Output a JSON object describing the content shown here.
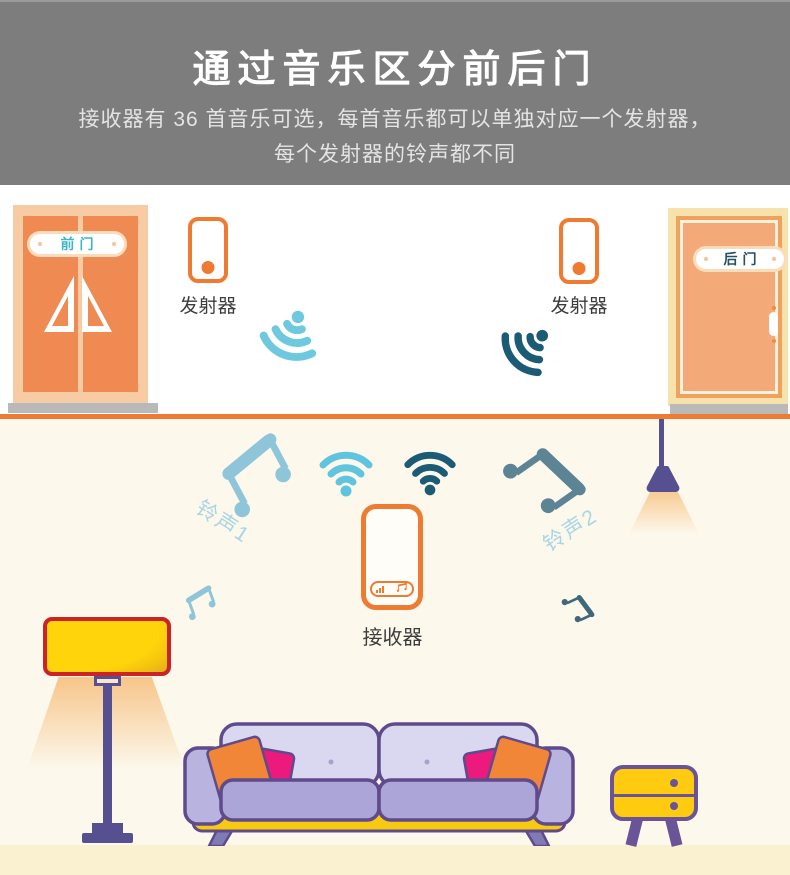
{
  "header": {
    "title": "通过音乐区分前后门",
    "subtitle1": "接收器有 36 首音乐可选，每首音乐都可以单独对应一个发射器，",
    "subtitle2": "每个发射器的铃声都不同"
  },
  "scene": {
    "front_door_label": "前门",
    "back_door_label": "后门",
    "transmitter_left_label": "发射器",
    "transmitter_right_label": "发射器",
    "receiver_label": "接收器",
    "ring1_label": "铃声1",
    "ring2_label": "铃声2"
  },
  "colors": {
    "header_gray": "#7D7D7D",
    "accent_orange": "#EE7B31",
    "door_orange": "#EF8A52",
    "door_frame_peach": "#F7CBA3",
    "back_door_salmon": "#F3AA78",
    "front_sign_text_teal": "#3EB5CB",
    "back_sign_text_navy": "#235066",
    "wifi_light_blue": "#5FC4DD",
    "wifi_dark_teal": "#1C5B76",
    "note_light_blue": "#8FC5D9",
    "note_slate": "#5D8495",
    "ring_label_blue": "#A9D6E4",
    "lamp_yellow": "#FFD40B",
    "lamp_red_border": "#CB2328",
    "lamp_purple": "#565090",
    "sofa_outline_purple": "#5F4B8B",
    "sofa_back_lavender": "#DAD7F0",
    "sofa_seat_lavender": "#ABA5D8",
    "sofa_base_yellow": "#F7C911",
    "pillow_orange": "#F18538",
    "pillow_pink": "#EC1A7D",
    "table_yellow": "#FFCB11",
    "table_purple": "#6B5397",
    "room_bottom_cream": "#FCF8EC",
    "floor_cream": "#F9F1CF"
  },
  "icons": {
    "wifi": "wifi-icon",
    "music_note": "music-note-icon",
    "door_triangles": "door-window-triangles"
  }
}
